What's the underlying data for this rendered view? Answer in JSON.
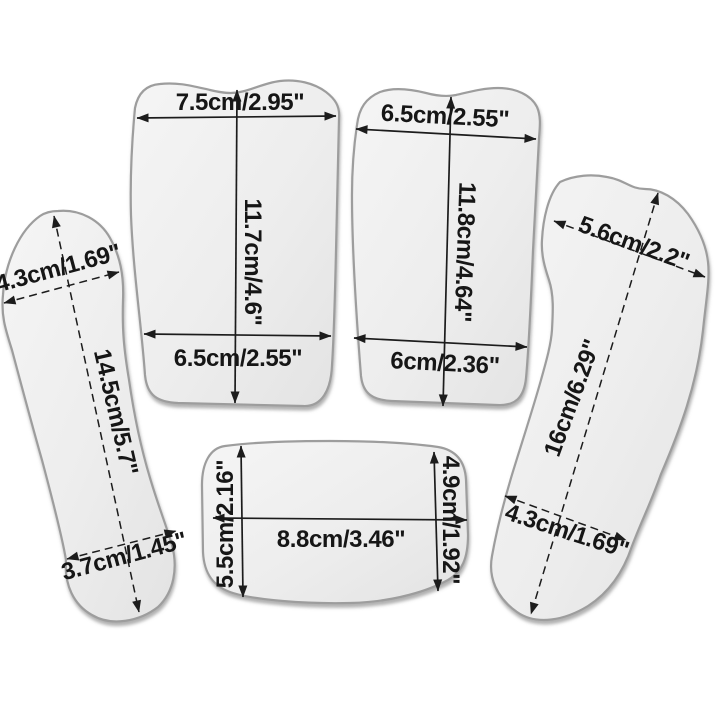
{
  "figure": {
    "title": "Dental photography mirrors dimension diagram",
    "background_color": "#ffffff",
    "shape_fill_light": "#f4f4f4",
    "shape_fill_dark": "#e6e6e6",
    "shape_stroke_color": "#9d9d9d",
    "annotation_color": "#161616"
  },
  "mirrors": [
    {
      "name": "large-posterior-mirror",
      "width_top": "7.5cm/2.95\"",
      "length": "11.7cm/4.6\"",
      "width_bottom": "6.5cm/2.55\""
    },
    {
      "name": "small-posterior-mirror",
      "width_top": "6.5cm/2.55\"",
      "length": "11.8cm/4.64\"",
      "width_bottom": "6cm/2.36\""
    },
    {
      "name": "left-occlusal-mirror",
      "width_top": "4.3cm/1.69\"",
      "length": "14.5cm/5.7\"",
      "width_bottom": "3.7cm/1.45\""
    },
    {
      "name": "right-occlusal-mirror",
      "width_top": "5.6cm/2.2\"",
      "length": "16cm/6.29\"",
      "width_bottom": "4.3cm/1.69\""
    },
    {
      "name": "lingual-mirror",
      "height_left": "5.5cm/2.16\"",
      "width": "8.8cm/3.46\"",
      "height_right": "4.9cm/1.92\""
    }
  ]
}
